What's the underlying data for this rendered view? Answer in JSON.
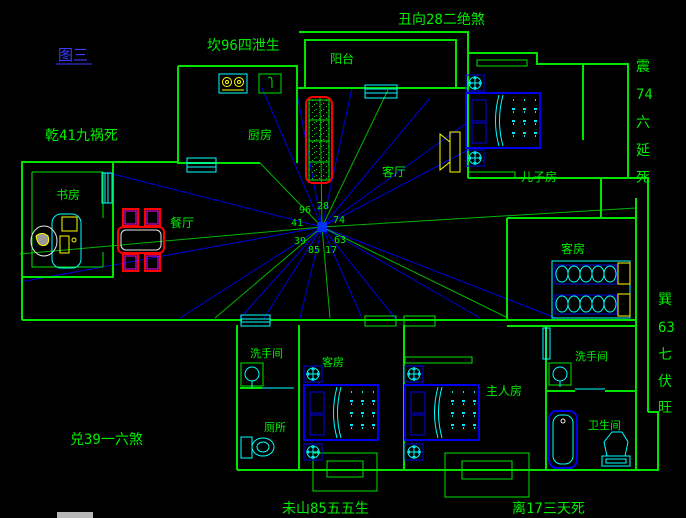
{
  "figure": {
    "label": "图三"
  },
  "fengshui": {
    "top": "丑向28二绝煞",
    "north": "坎96四泄生",
    "northwest": "乾41九祸死",
    "west": "兑39一六煞",
    "southwest": "未山85五五生",
    "south": "离17三天死",
    "east": [
      "震",
      "74",
      "六",
      "延",
      "死"
    ],
    "southeast": [
      "巽",
      "63",
      "七",
      "伏",
      "旺"
    ]
  },
  "rooms": {
    "balcony": "阳台",
    "kitchen": "厨房",
    "living": "客厅",
    "son": "儿子房",
    "study": "书房",
    "dining": "餐厅",
    "guest_right": "客房",
    "washroom_left": "洗手间",
    "toilet": "厕所",
    "guest_bottom": "客房",
    "master": "主人房",
    "washroom_right": "洗手间",
    "bathroom": "卫生间"
  },
  "center_numbers": {
    "n96": "96",
    "n28": "28",
    "n41": "41",
    "n74": "74",
    "n39": "39",
    "n63": "63",
    "n85": "85",
    "n17": "17"
  },
  "colors": {
    "bg": "#000000",
    "wall": "#00e400",
    "text": "#00ee00",
    "figure": "#3c3cff",
    "window": "#00ffff",
    "furn": "#0000ee",
    "rayblue": "#0000dd",
    "raygreen": "#00b400",
    "table": "#ff0000",
    "chair": "#ff00ff",
    "accent": "#ffff00"
  }
}
